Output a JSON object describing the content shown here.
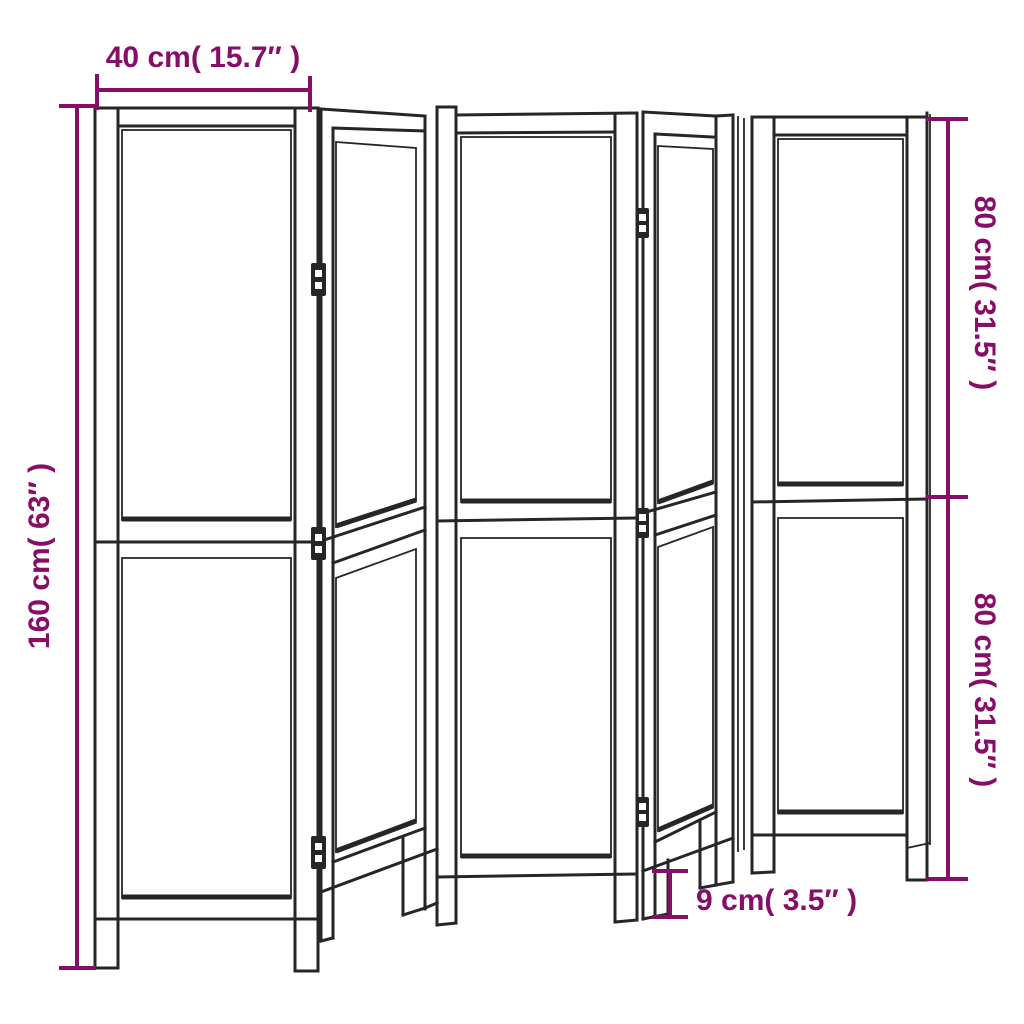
{
  "diagram": {
    "subject": "five-panel-folding-room-divider-dimension-drawing",
    "background_color": "#ffffff",
    "line_color": "#262626",
    "dimension_color": "#870E68",
    "panel_count": 5,
    "visible_hinge_count": 6,
    "dimensions": {
      "panel_width": "40 cm( 15.7″ )",
      "total_height": "160 cm( 63″ )",
      "upper_section_height": "80 cm( 31.5″ )",
      "lower_section_height": "80 cm( 31.5″ )",
      "leg_height": "9 cm( 3.5″ )"
    }
  }
}
